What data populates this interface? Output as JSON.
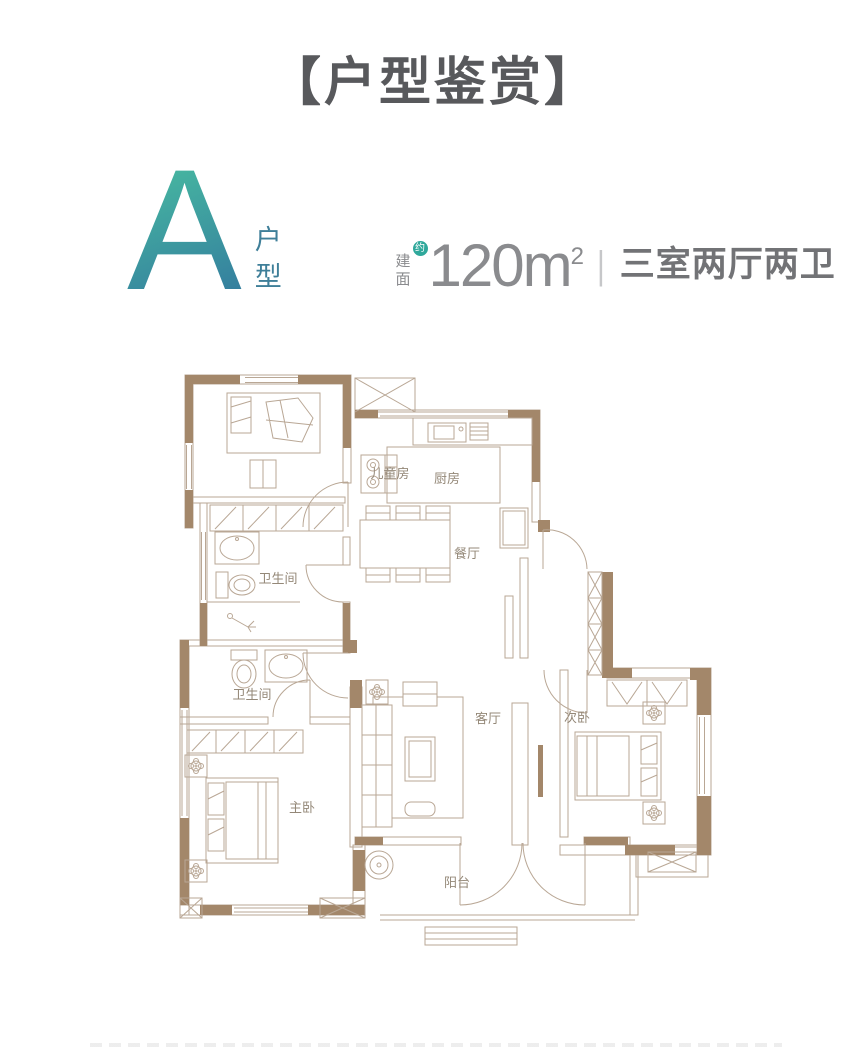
{
  "header": {
    "title": "【户型鉴赏】"
  },
  "unit": {
    "type_letter": "A",
    "type_label": "户型",
    "area_label": "建面",
    "area_approx_badge": "约",
    "area_value": "120m",
    "area_superscript": "2",
    "spec_divider": "|",
    "layout_text": "三室两厅两卫"
  },
  "floorplan": {
    "rooms": [
      {
        "label": "儿童房",
        "x": 220,
        "y": 128
      },
      {
        "label": "厨房",
        "x": 277,
        "y": 133
      },
      {
        "label": "餐厅",
        "x": 297,
        "y": 208
      },
      {
        "label": "卫生间",
        "x": 108,
        "y": 233
      },
      {
        "label": "卫生间",
        "x": 82,
        "y": 349
      },
      {
        "label": "主卧",
        "x": 132,
        "y": 462
      },
      {
        "label": "客厅",
        "x": 318,
        "y": 373
      },
      {
        "label": "次卧",
        "x": 407,
        "y": 372
      },
      {
        "label": "阳台",
        "x": 287,
        "y": 537
      }
    ]
  },
  "colors": {
    "accent": "#2fa89b",
    "gradTop": "#45b2a0",
    "gradBottom": "#2f6f9e",
    "wall": "#a3876a",
    "line": "#b9a795",
    "titleText": "#58595c",
    "specText": "#8a8b8e",
    "layoutText": "#727376",
    "roomLabel": "#948878"
  }
}
